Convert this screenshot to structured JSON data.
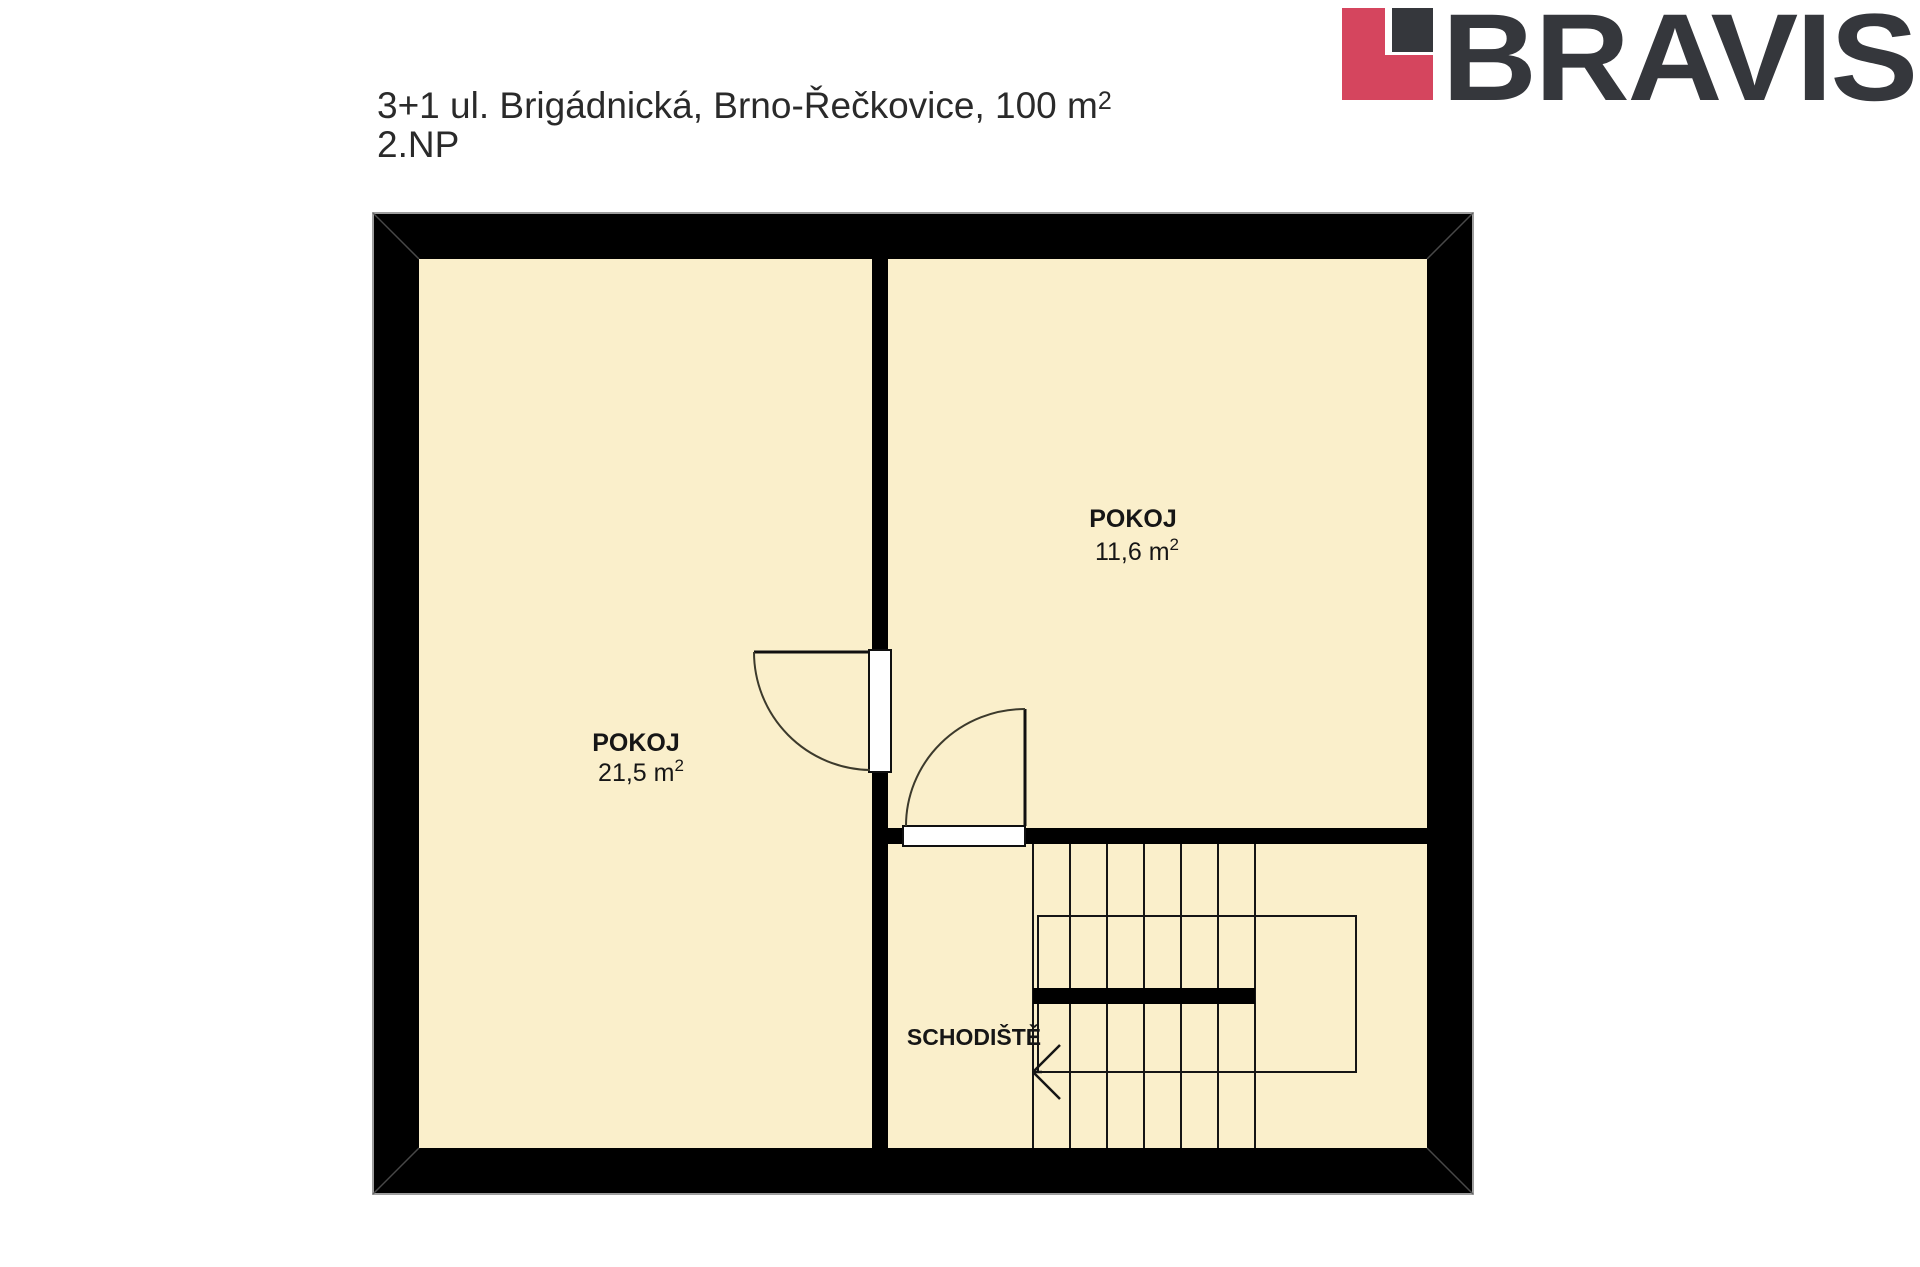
{
  "header": {
    "title": "3+1 ul. Brigádnická, Brno-Řečkovice, 100 m",
    "title_sup": "2",
    "floor": "2.NP"
  },
  "logo": {
    "text": "BRAVIS",
    "red": "#D5455E",
    "dark": "#35373C"
  },
  "floorplan": {
    "wall_color": "#000000",
    "floor_color": "#FAEFCB",
    "line_color": "#1c1c1c",
    "rooms": {
      "left": {
        "name": "POKOJ",
        "area_value": "21,5 m",
        "area_sup": "2"
      },
      "right": {
        "name": "POKOJ",
        "area_value": "11,6 m",
        "area_sup": "2"
      },
      "stairs": {
        "name": "SCHODIŠTĚ"
      }
    }
  }
}
